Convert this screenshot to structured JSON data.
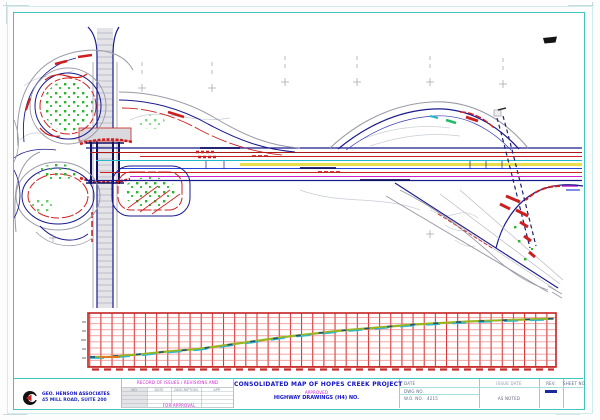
{
  "title_block": {
    "company": {
      "line1": "GEO. HENSON ASSOCIATES",
      "line2": "45 MILL ROAD, SUITE 200"
    },
    "revisions": {
      "header": "RECORD OF ISSUES / REVISIONS AND",
      "columns": [
        "NO.",
        "DATE",
        "DESCRIPTION",
        "APP."
      ],
      "footer": "FOR APPROVAL"
    },
    "title": "CONSOLIDATED MAP OF HOPES CREEK PROJECT",
    "approval_tag": "APPROVED",
    "subtitle": "HIGHWAY DRAWINGS (H4) NO.",
    "fields": {
      "date_label": "DATE",
      "dwg_label": "DWG NO.",
      "wo_label": "W.O. NO.",
      "wo_value": "4215",
      "scale_header": "ISSUE DATE",
      "scale_value": "AS NOTED",
      "rev_label": "REV.",
      "sheet_label": "SHEET NO."
    }
  },
  "colors": {
    "frame": "#3fc6c0",
    "grid_red": "#d83030",
    "mainline_navy": "#1a1a8c",
    "vegetation_green": "#2ab52a",
    "profile_line": "#9ab520"
  }
}
